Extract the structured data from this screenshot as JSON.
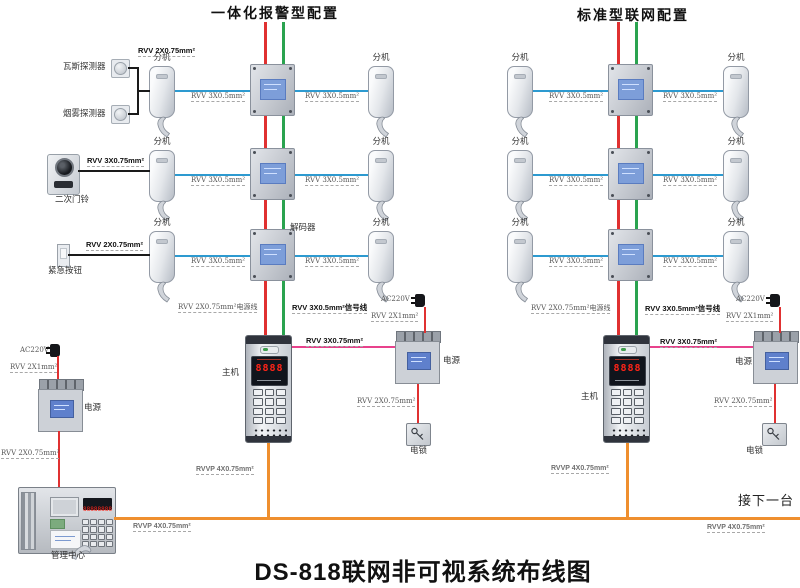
{
  "diagram_title": "DS-818联网非可视系统布线图",
  "sections": [
    {
      "title": "一体化报警型配置"
    },
    {
      "title": "标准型联网配置"
    }
  ],
  "labels": {
    "extension": "分机",
    "decoder": "解码器",
    "host": "主机",
    "power": "电源",
    "lock": "电锁",
    "management_center": "管理中心",
    "next_unit": "接下一台",
    "ac": "AC220V",
    "gas_detector": "瓦斯探测器",
    "smoke_detector": "烟雾探测器",
    "doorbell": "二次门铃",
    "emergency_button": "紧急按钮"
  },
  "cables": {
    "detector": "RVV 2X0.75mm²",
    "signal": "RVV 3X0.5mm²",
    "doorbell": "RVV 3X0.75mm²",
    "emergency": "RVV 2X0.75mm²",
    "power_line": "RVV 2X0.75mm²电源线",
    "signal_line": "RVV 3X0.5mm²信号线",
    "host_power": "RVV 3X0.75mm²",
    "ac_power": "RVV 2X1mm²",
    "lock_power": "RVV 2X0.75mm²",
    "mgmt_power": "RVV 2X0.75mm²",
    "riser": "RVVP 4X0.75mm²"
  },
  "devices": {
    "host_display": "8888",
    "console_display": "88888888"
  },
  "colors": {
    "signal_wire": "#2d9ad0",
    "power_wire": "#e03131",
    "data_wire": "#2aa34f",
    "host_power_wire": "#e8418c",
    "trunk_wire": "#ef8f2e",
    "peripheral_wire": "#1a1a1a"
  }
}
